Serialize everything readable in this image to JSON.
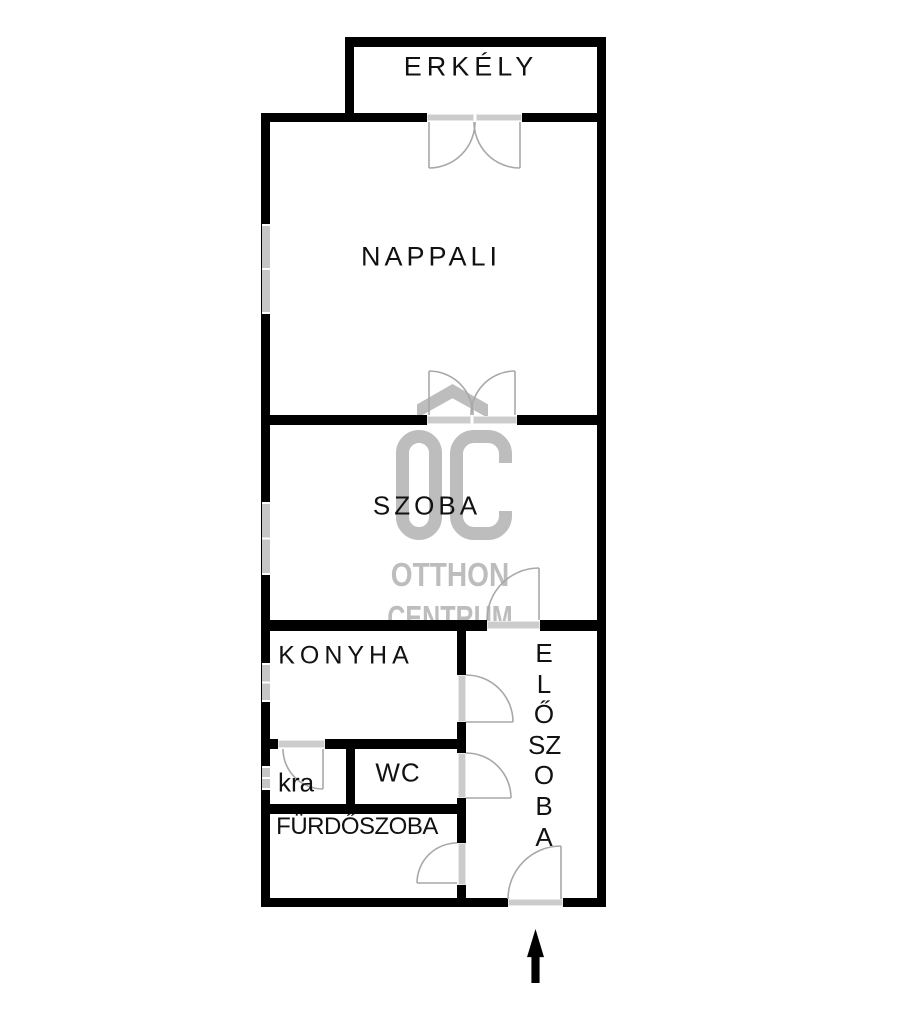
{
  "floorplan": {
    "type": "apartment floor plan",
    "rooms": [
      {
        "id": "erkely",
        "label": "ERKÉLY"
      },
      {
        "id": "nappali",
        "label": "NAPPALI"
      },
      {
        "id": "szoba",
        "label": "SZOBA"
      },
      {
        "id": "konyha",
        "label": "KONYHA"
      },
      {
        "id": "kra",
        "label": "kra"
      },
      {
        "id": "wc",
        "label": "WC"
      },
      {
        "id": "furdoszoba",
        "label": "FÜRDŐSZOBA"
      },
      {
        "id": "eloszoba",
        "label": "ELŐSZOBA",
        "vertical_letters": [
          "E",
          "L",
          "Ő",
          "SZ",
          "O",
          "B",
          "A"
        ]
      }
    ],
    "watermark": {
      "logo": "OC",
      "line1": "OTTHON",
      "line2": "CENTRUM",
      "color": "#bdbdbd"
    },
    "entrance": {
      "icon": "up-arrow",
      "meaning": "main entrance direction"
    },
    "colors": {
      "wall": "#000000",
      "door": "#a8a8a8",
      "threshold": "#cccccc",
      "window": "#c6c6c6",
      "label": "#111111",
      "background": "#ffffff"
    }
  }
}
